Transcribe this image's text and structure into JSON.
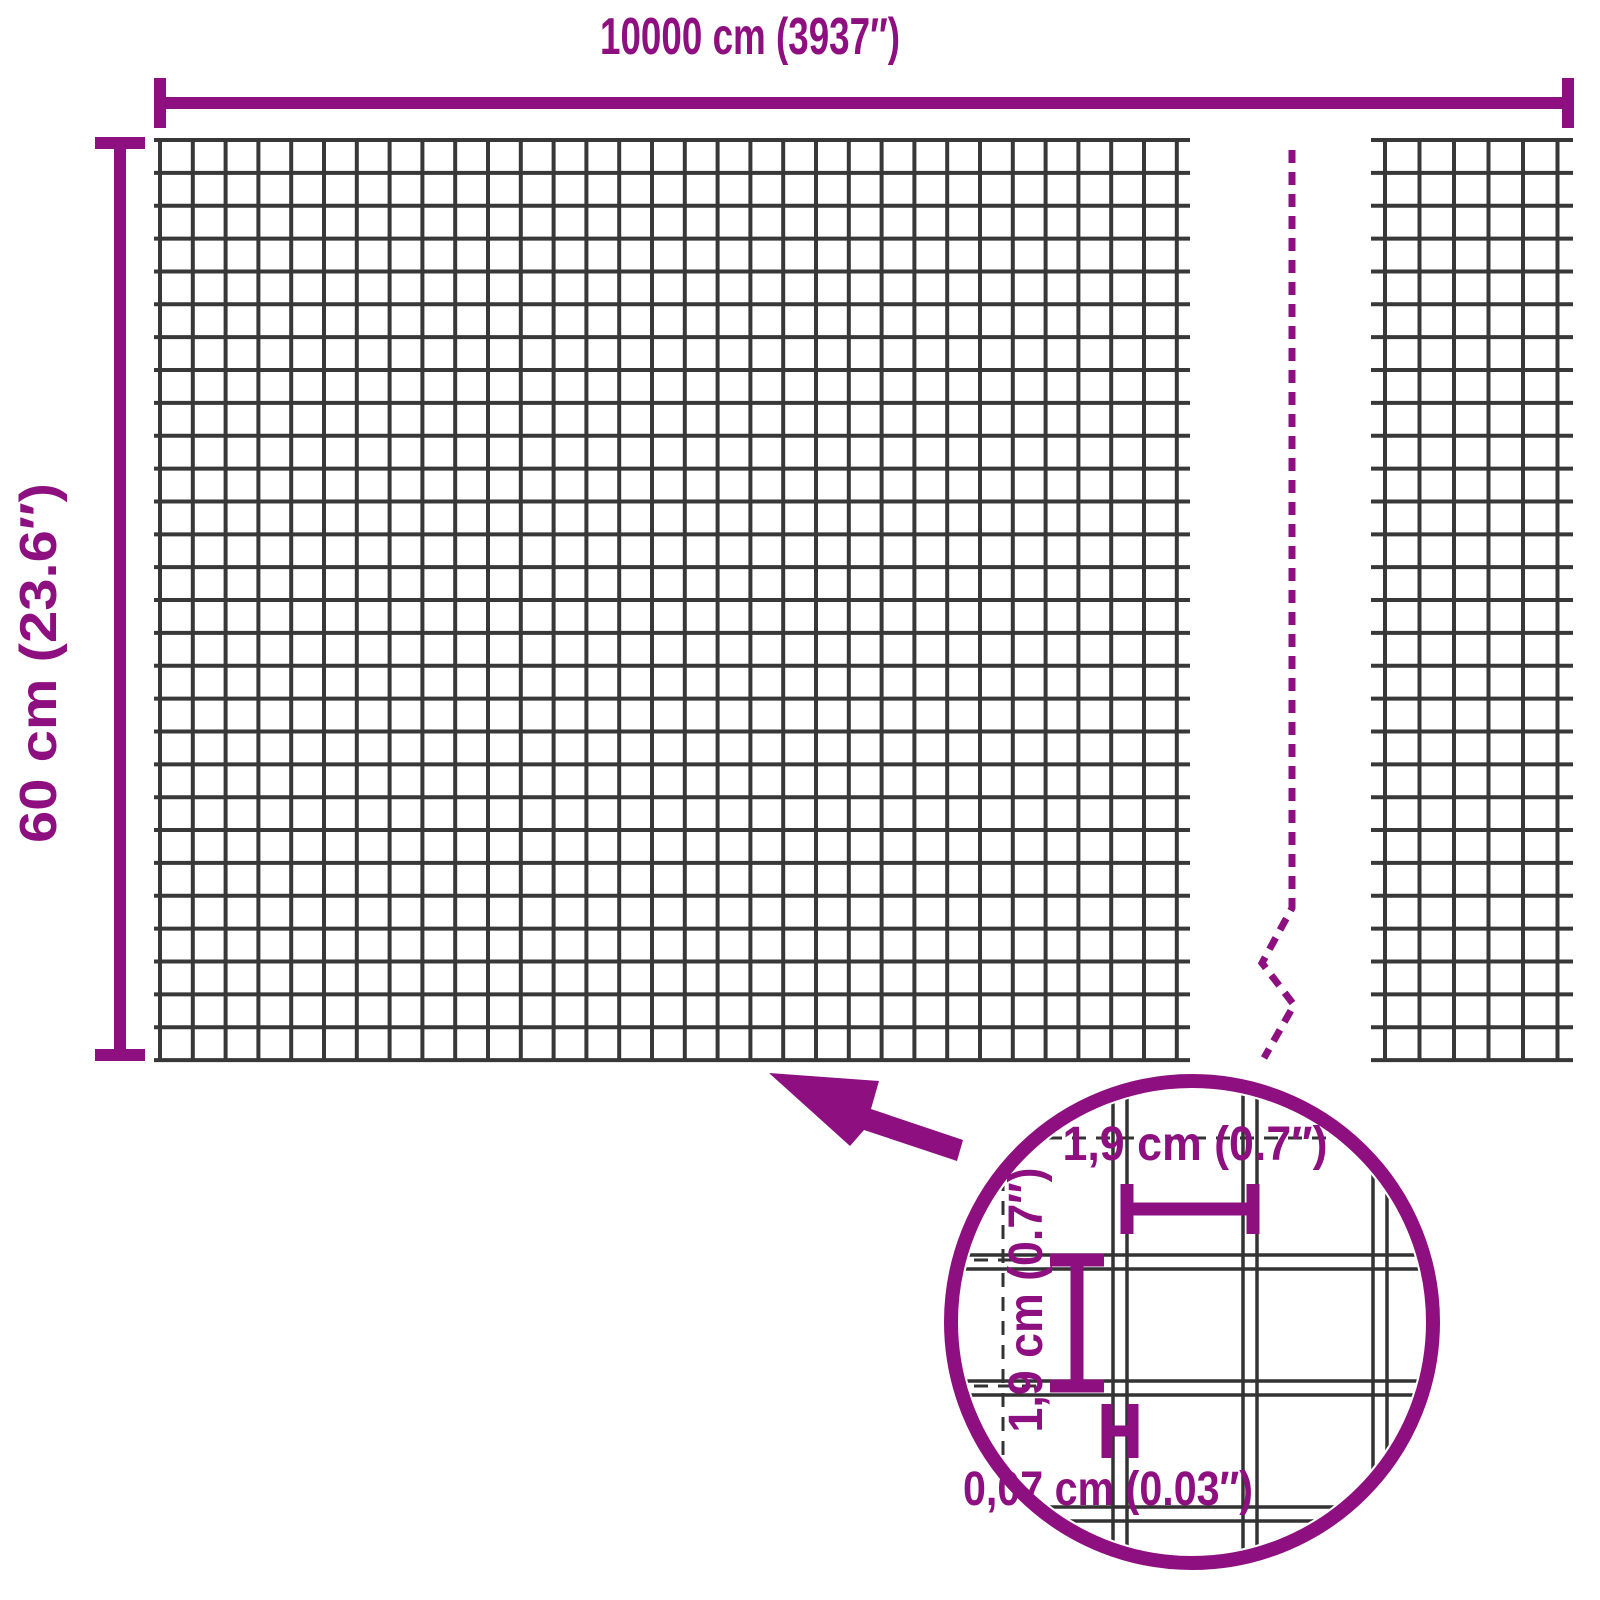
{
  "colors": {
    "accent": "#8e1080",
    "mesh_line": "#383838",
    "detail_line": "#333333"
  },
  "dimensions": {
    "total_width_label": "10000 cm (3937″)",
    "total_height_label": "60 cm (23.6″)",
    "mesh_opening_width_label": "1,9 cm (0.7″)",
    "mesh_opening_height_label": "1,9 cm (0.7″)",
    "wire_thickness_label": "0,07 cm (0.03″)"
  },
  "geometry": {
    "large_grid": {
      "x0": 160,
      "y0": 140,
      "x1": 1178,
      "y1": 1060,
      "vcell": 32.8,
      "hcell": 32.86,
      "hx0": 154,
      "hx1": 1190
    },
    "small_grid": {
      "x0": 1385,
      "y0": 140,
      "x1": 1560,
      "y1": 1060,
      "vcell": 34.5,
      "hcell": 32.86,
      "hx0": 1371,
      "hx1": 1573
    },
    "detail_mesh": {
      "clip_cx": 1192,
      "clip_cy": 1322,
      "clip_r": 232,
      "v_wires": [
        1120,
        1250,
        1380
      ],
      "h_wires": [
        1262,
        1388,
        1514
      ],
      "wire_half_gap": 7,
      "x_min": 950,
      "x_max": 1434,
      "y_min": 1078,
      "y_max": 1566
    }
  }
}
